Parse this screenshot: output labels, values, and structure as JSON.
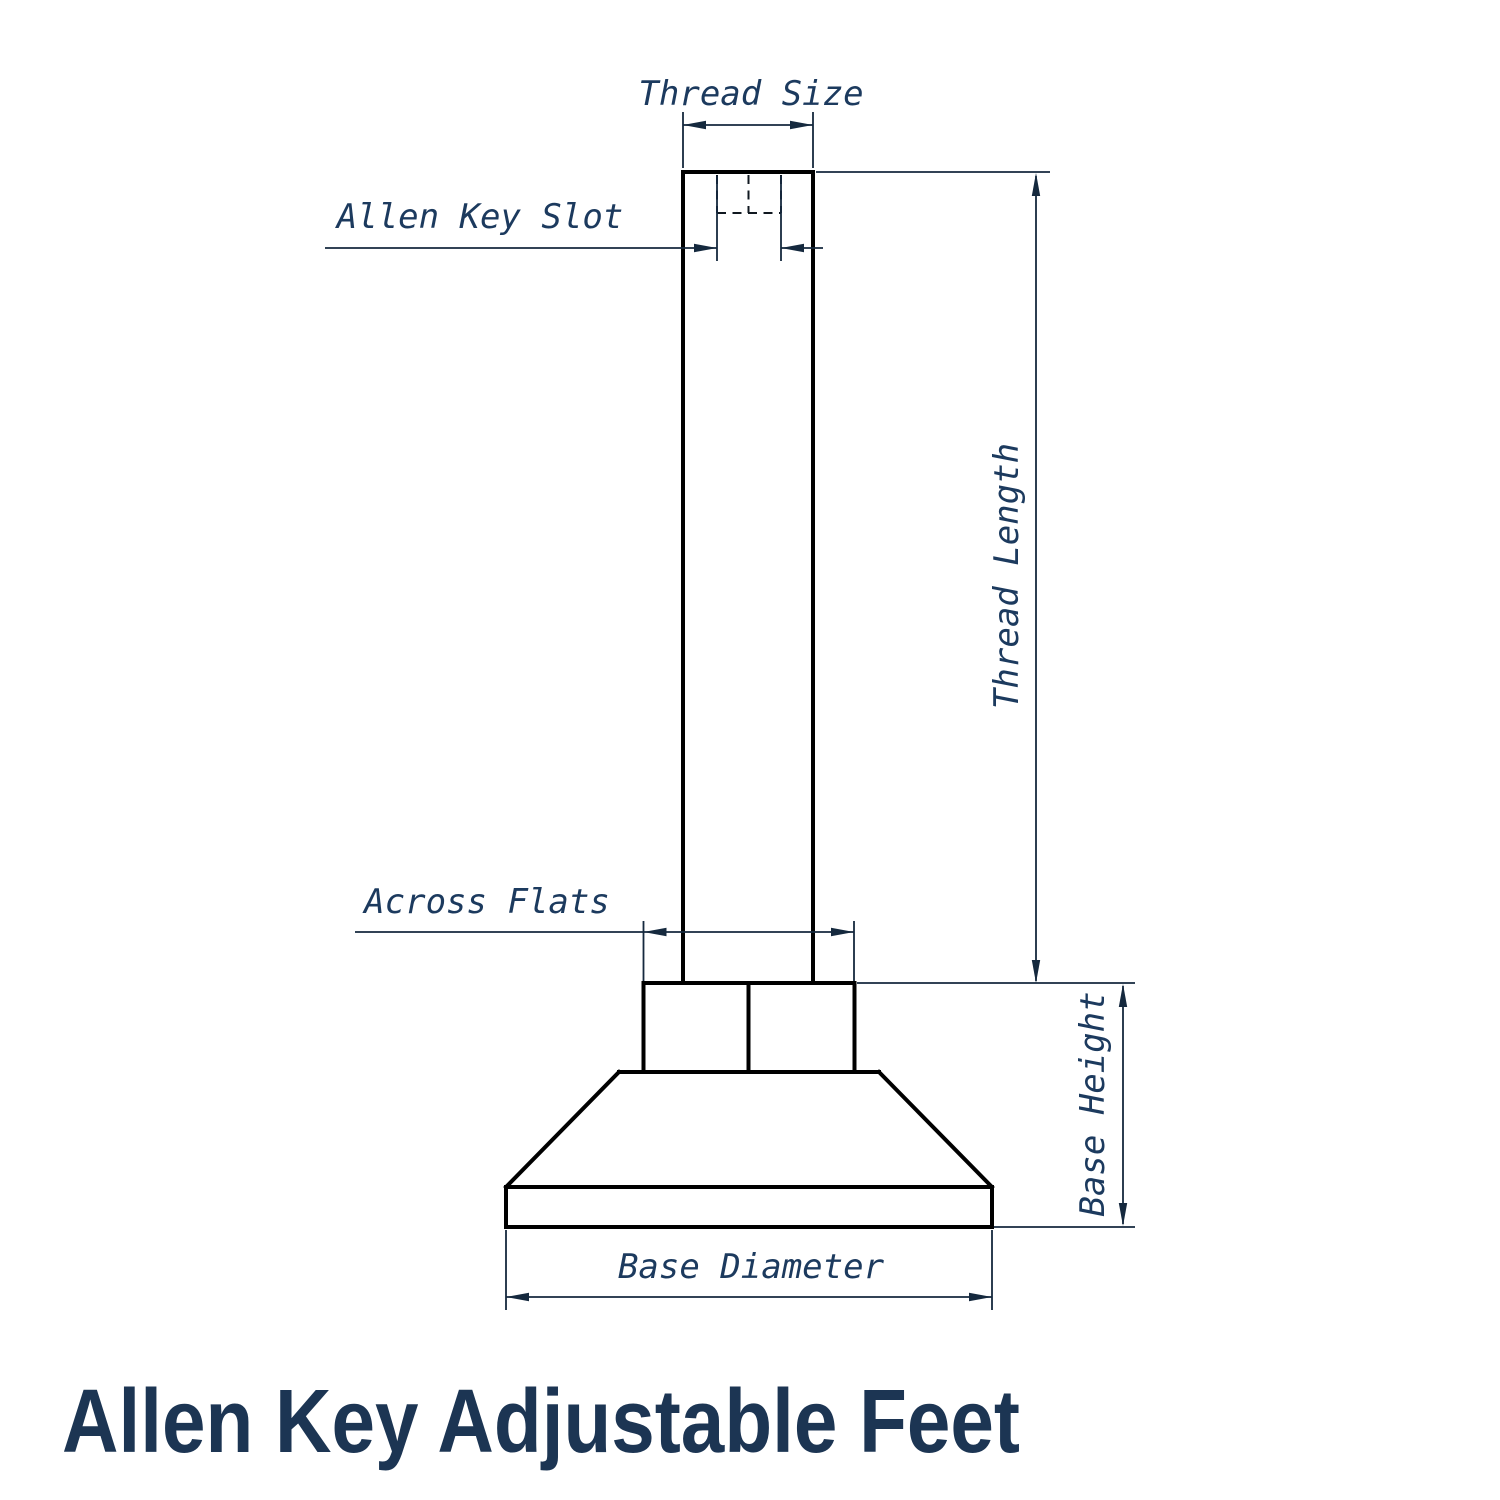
{
  "title": {
    "text": "Allen Key Adjustable Feet",
    "color": "#1c3553"
  },
  "drawing": {
    "name": "allen-key-adjustable-foot-technical-drawing",
    "labels": {
      "thread_size": "Thread Size",
      "allen_key_slot": "Allen Key Slot",
      "thread_length": "Thread Length",
      "across_flats": "Across Flats",
      "base_height": "Base Height",
      "base_diameter": "Base Diameter"
    },
    "colors": {
      "outline": "#000000",
      "hidden_line": "#101820",
      "dimension": "#15293e",
      "label": "#1c3a5e",
      "background": "#ffffff"
    }
  }
}
